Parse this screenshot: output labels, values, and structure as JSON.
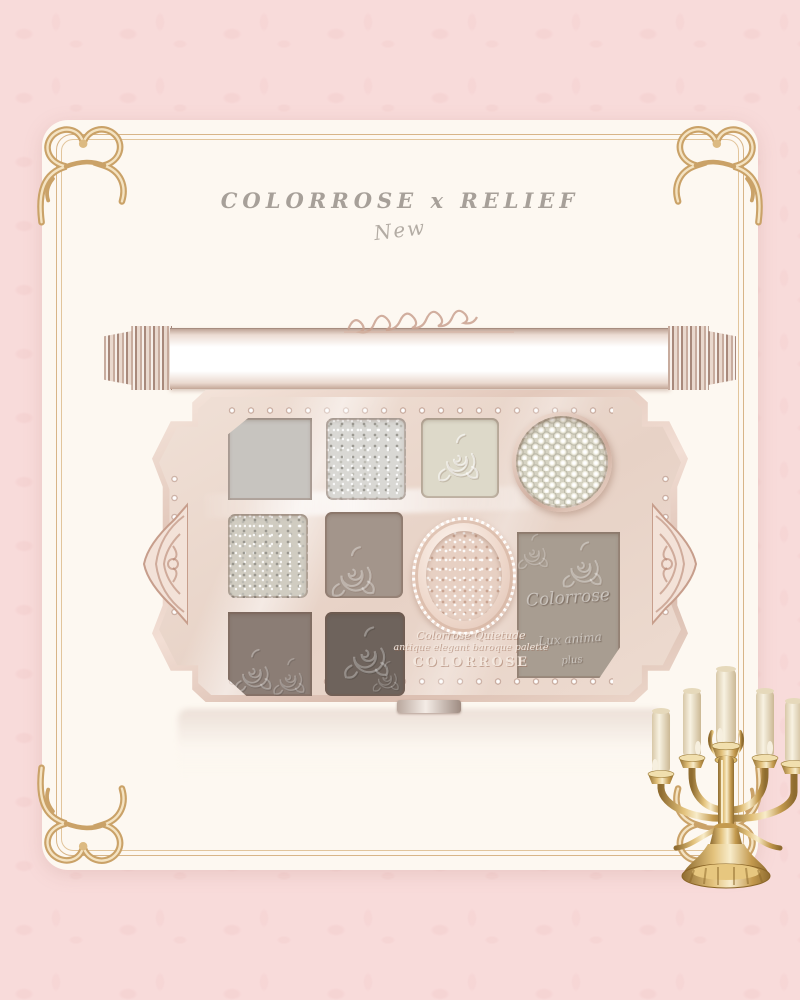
{
  "theme": {
    "background": "#f8dbda",
    "card": "#fdf8f1",
    "frame_gold": "#d2ae7c",
    "metal_rosegold": "#e9d0c3",
    "title_color": "#a7a099",
    "candelabra_gold": "#c49a4e",
    "candle_ivory": "#f6efdf"
  },
  "header": {
    "title": "COLORROSE x RELIEF",
    "subtitle": "New"
  },
  "palette": {
    "emboss": {
      "line1": "Colorrose Quietude",
      "line2": "antique elegant baroque palette",
      "brand": "COLORROSE"
    },
    "big_pan": {
      "line1": "Colorrose",
      "line2": "Lux anima",
      "line3": "plus"
    },
    "pans": [
      {
        "name": "matte-light-gray",
        "finish": "matte",
        "color": "#c7c4bf"
      },
      {
        "name": "silver-glitter",
        "finish": "glitter",
        "color": "#d9d8d4"
      },
      {
        "name": "ivory-rose-emboss",
        "finish": "shimmer",
        "color": "#ddd9c9"
      },
      {
        "name": "champagne-glitter",
        "finish": "glitter",
        "color": "#d0ccc1"
      },
      {
        "name": "taupe-rose-emboss",
        "finish": "matte",
        "color": "#a3958b"
      },
      {
        "name": "mocha-rose-emboss",
        "finish": "matte",
        "color": "#8b7d75"
      },
      {
        "name": "charcoal-rose-emboss",
        "finish": "matte",
        "color": "#6e635c"
      },
      {
        "name": "greige-large-pan",
        "finish": "matte",
        "color": "#a89d91"
      }
    ],
    "pearl_pan": {
      "name": "pearl-topper",
      "base": "#d6d3c3"
    }
  },
  "decor": {
    "candelabra": "five-arm-gold-candelabra",
    "frame": "baroque-gold-frame"
  }
}
